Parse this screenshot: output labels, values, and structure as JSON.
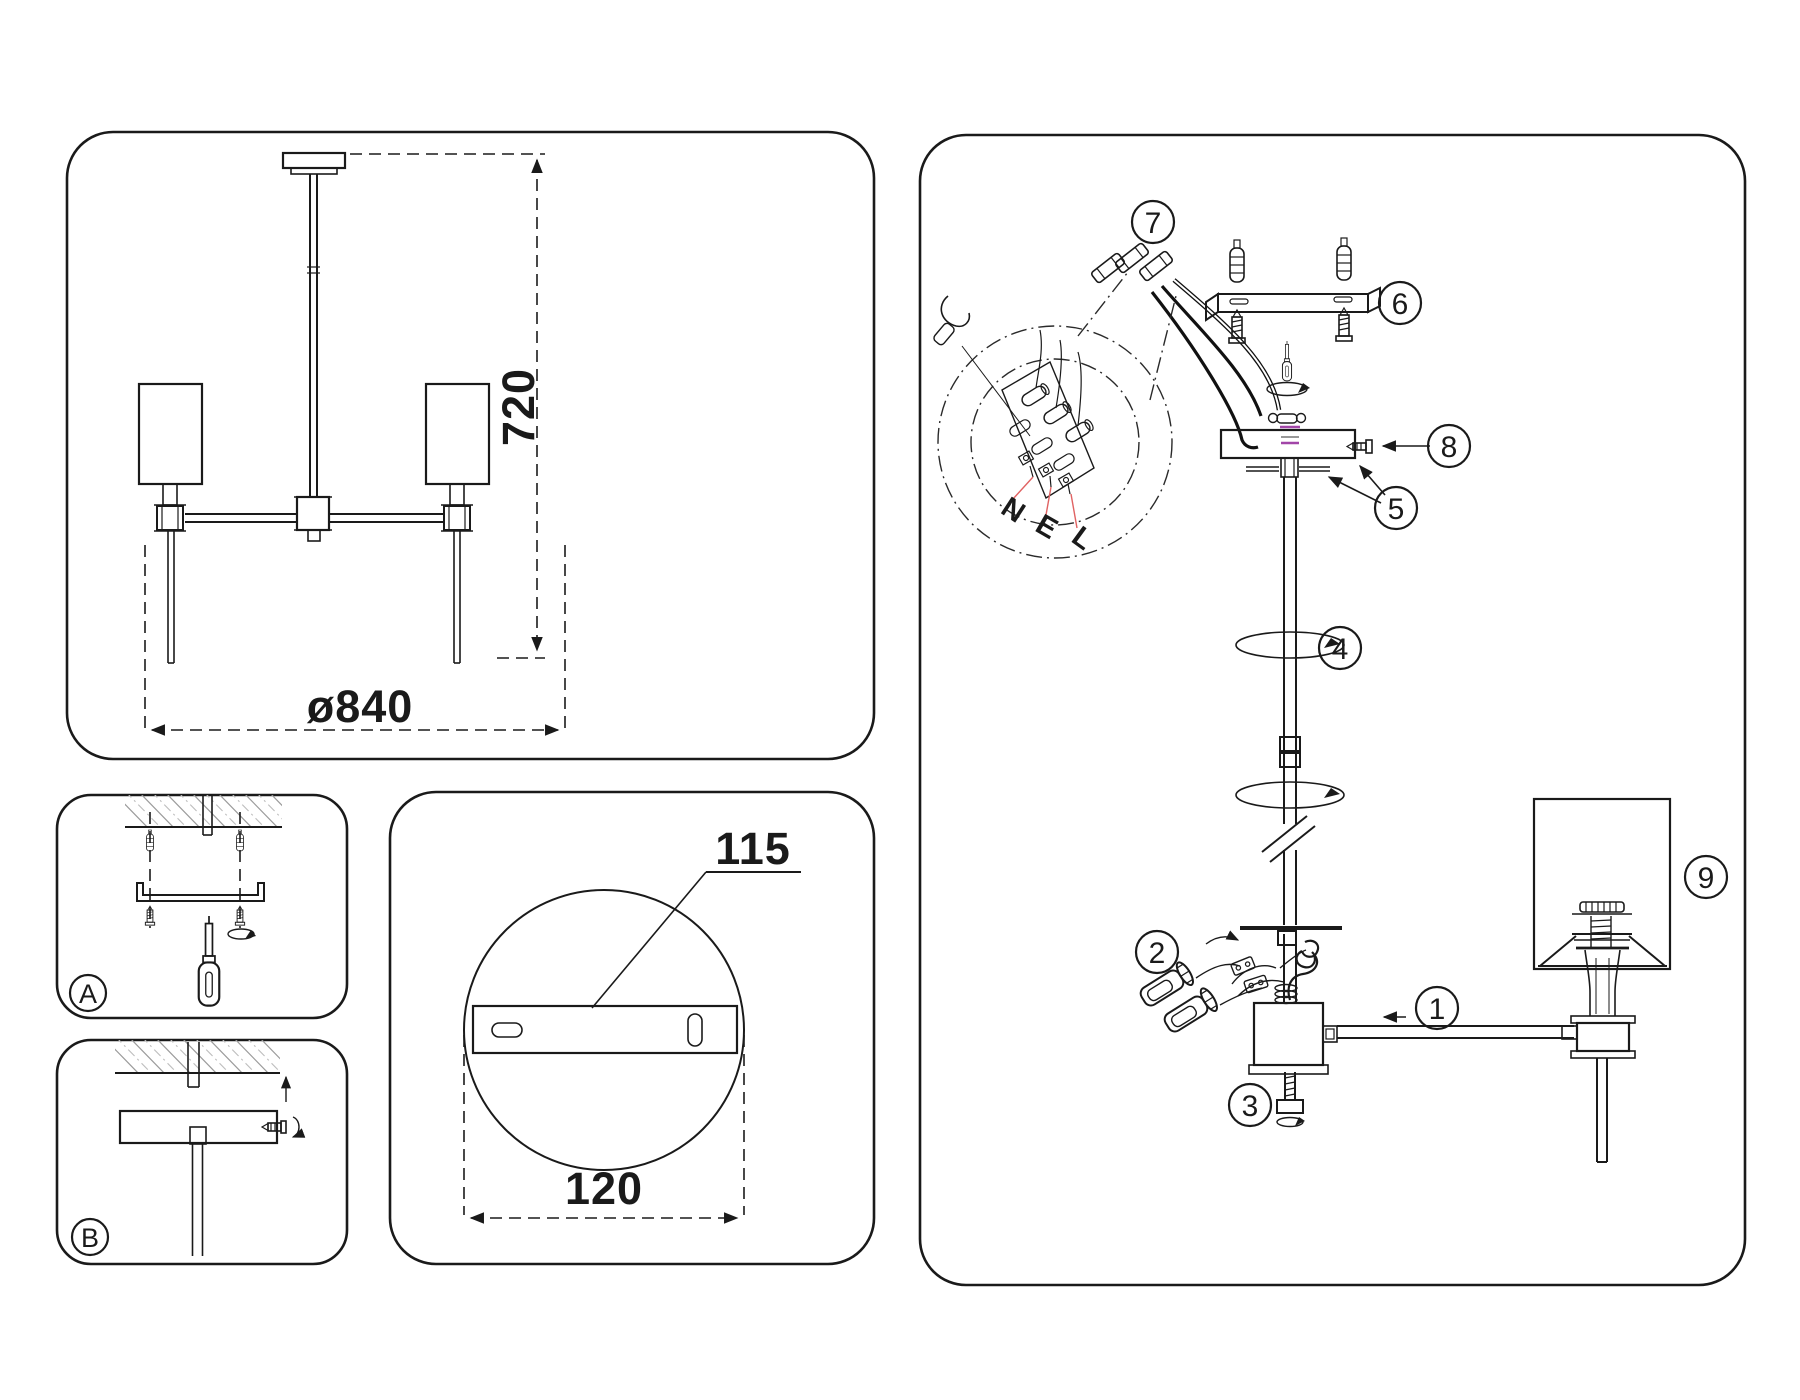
{
  "drawing": {
    "dimensions": {
      "height": "720",
      "diameter": "ø840",
      "plate_length": "115",
      "plate_width": "120"
    },
    "steps": {
      "a": "A",
      "b": "B"
    },
    "wires": {
      "neutral": "N",
      "earth": "E",
      "live": "L"
    },
    "callouts": {
      "1": "1",
      "2": "2",
      "3": "3",
      "4": "4",
      "5": "5",
      "6": "6",
      "7": "7",
      "8": "8",
      "9": "9"
    }
  }
}
